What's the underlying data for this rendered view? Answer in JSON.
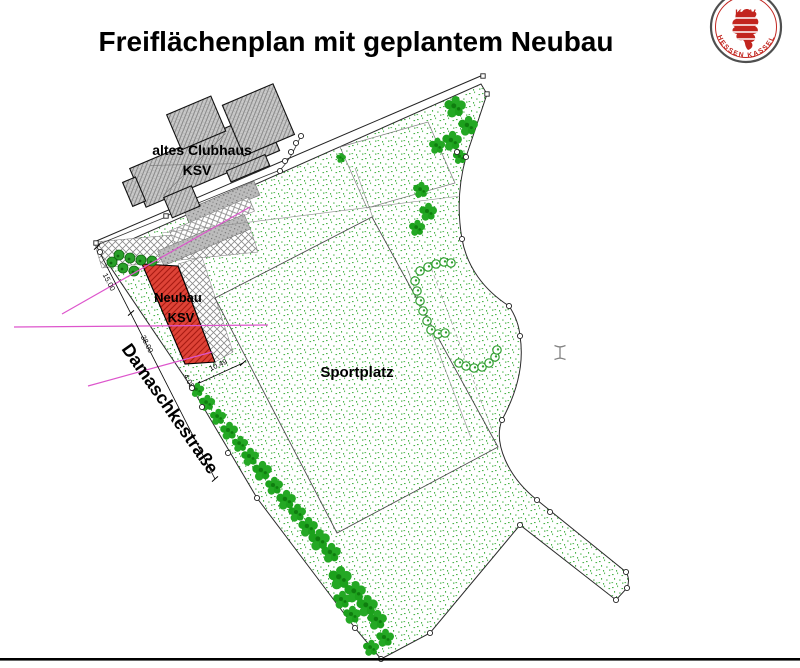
{
  "title": "Freiflächenplan mit geplantem Neubau",
  "logo": {
    "top_text": "KSV",
    "bottom_text": "HESSEN  KASSEL",
    "accent_color": "#c2251f"
  },
  "plan": {
    "old_clubhouse_label_1": "altes Clubhaus",
    "old_clubhouse_label_2": "KSV",
    "new_building_label_1": "Neubau",
    "new_building_label_2": "KSV",
    "sports_field_label": "Sportplatz",
    "street_label": "Damaschkestraße",
    "dim_frontage_upper": "15.00",
    "dim_frontage_lower": "38.00",
    "dim_small": "4.05",
    "dim_building": "10.49",
    "colors": {
      "site_stipple_green": "#4db44d",
      "tree_green": "#1a9e1a",
      "hedge_green": "#2f9e2f",
      "building_red": "#d93b30",
      "pavement_gray": "#b5b5b5",
      "boundary_black": "#222222",
      "utility_magenta": "#dd55cc"
    }
  }
}
